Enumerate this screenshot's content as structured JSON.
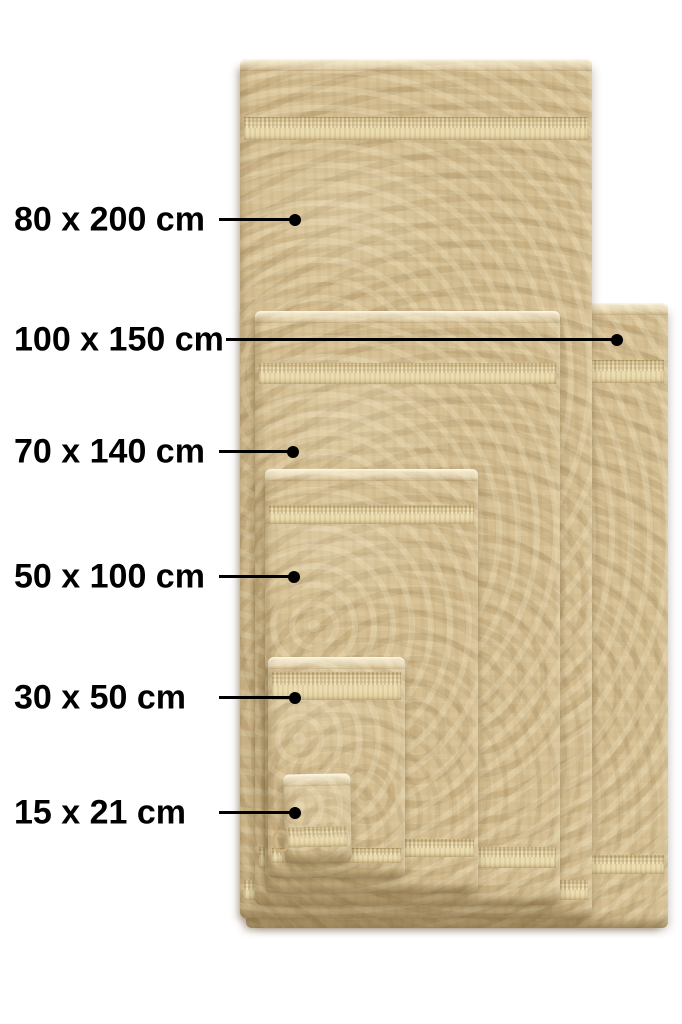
{
  "callouts": [
    {
      "id": "80x200",
      "text": "80 x 200 cm"
    },
    {
      "id": "100x150",
      "text": "100 x 150 cm"
    },
    {
      "id": "70x140",
      "text": "70 x 140 cm"
    },
    {
      "id": "50x100",
      "text": "50 x 100 cm"
    },
    {
      "id": "30x50",
      "text": "30 x 50 cm"
    },
    {
      "id": "15x21",
      "text": "15 x 21 cm"
    }
  ],
  "colors": {
    "towel_base": "#d5bf92",
    "towel_band": "#e9d8aa",
    "annotation": "#000000",
    "background": "#ffffff"
  }
}
